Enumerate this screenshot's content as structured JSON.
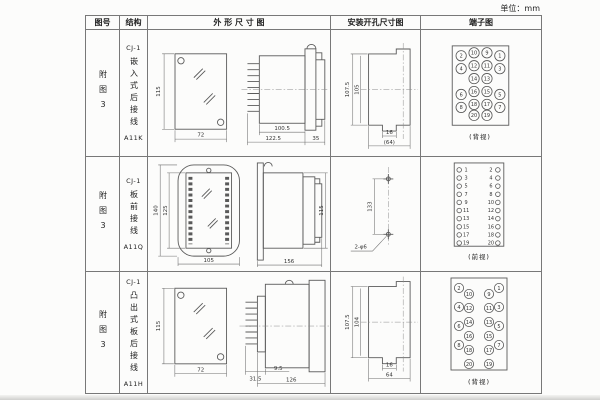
{
  "unit_label": "单位：mm",
  "table": {
    "headers": [
      "图号",
      "结构",
      "外 形 尺 寸 图",
      "安装开孔尺寸图",
      "端子图"
    ],
    "rows": [
      {
        "fig_no": "附图3",
        "model_prefix": "CJ-1",
        "structure": "嵌入式后接线",
        "model": "A11K",
        "outline": {
          "front_h": "115",
          "front_w": "72",
          "side_a": "100.5",
          "side_b": "122.5",
          "side_c": "35"
        },
        "mounting": {
          "v1": "107.5",
          "v2": "105",
          "h1": "16",
          "h2": "(64)"
        },
        "terminal": {
          "caption": "(背视)",
          "grid": [
            [
              "2",
              "10",
              "9",
              "1"
            ],
            [
              "4",
              "12",
              "11",
              "3"
            ],
            [
              "",
              "14",
              "13",
              ""
            ],
            [
              "6",
              "16",
              "15",
              "5"
            ],
            [
              "8",
              "18",
              "17",
              "7"
            ],
            [
              "",
              "20",
              "19",
              ""
            ]
          ]
        }
      },
      {
        "fig_no": "附图3",
        "model_prefix": "CJ-1",
        "structure": "板前接线",
        "model": "A11Q",
        "outline": {
          "front_h": "140",
          "front_h2": "125",
          "front_w": "105",
          "side_w": "156",
          "side_h": "115"
        },
        "mounting": {
          "v": "133",
          "holes": "2-φ6"
        },
        "terminal": {
          "caption": "(前视)",
          "left": [
            "1",
            "3",
            "5",
            "7",
            "9",
            "11",
            "13",
            "15",
            "17",
            "19"
          ],
          "right": [
            "2",
            "4",
            "6",
            "8",
            "10",
            "12",
            "14",
            "16",
            "18",
            "20"
          ]
        }
      },
      {
        "fig_no": "附图3",
        "model_prefix": "CJ-1",
        "structure": "凸出式板后接线",
        "model": "A11H",
        "outline": {
          "front_h": "115",
          "front_w": "72",
          "side_a": "31.5",
          "side_b": "9.5",
          "side_c": "126"
        },
        "mounting": {
          "v1": "107.5",
          "v2": "104",
          "h1": "16",
          "h2": "64"
        },
        "terminal": {
          "caption": "(背视)",
          "left_outer": [
            "2",
            "4",
            "6",
            "8"
          ],
          "left_inner": [
            "10",
            "12",
            "14",
            "16",
            "18",
            "20"
          ],
          "right_inner": [
            "9",
            "11",
            "13",
            "15",
            "17",
            "19"
          ],
          "right_outer": [
            "1",
            "3",
            "5",
            "7"
          ]
        }
      }
    ]
  }
}
